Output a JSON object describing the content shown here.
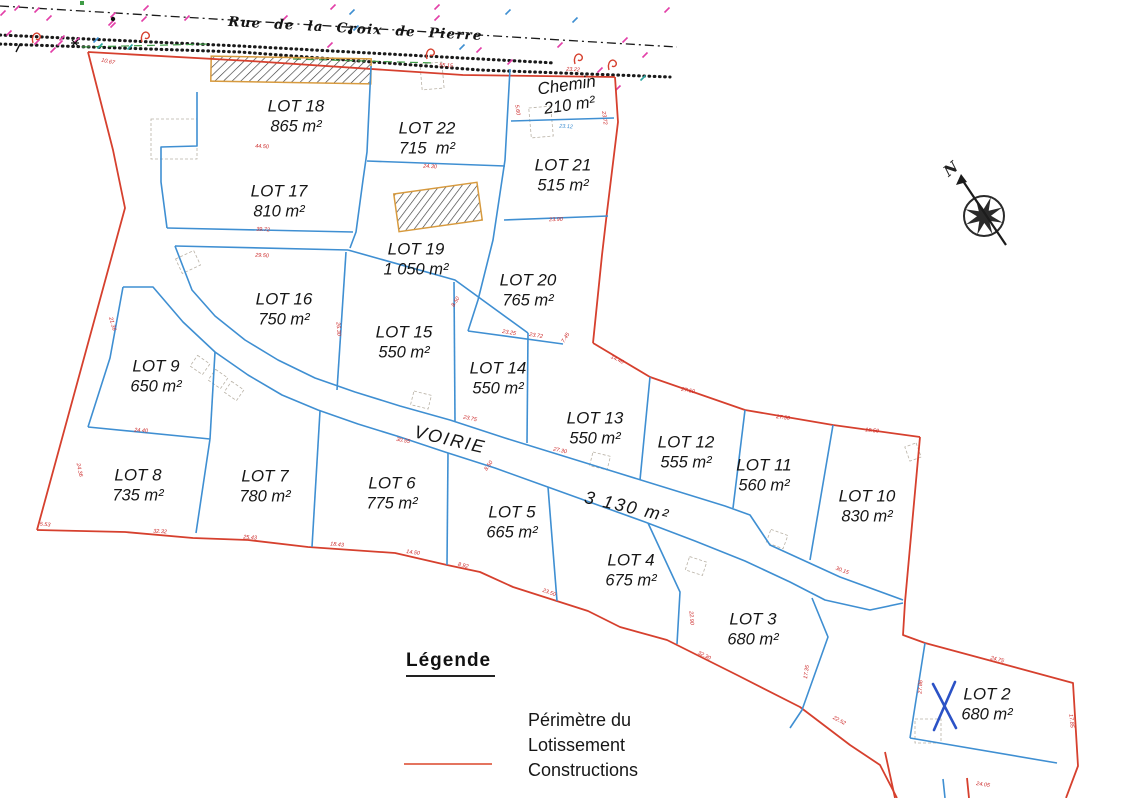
{
  "street": {
    "name": "Rue de la Croix de Pierre"
  },
  "compass": {
    "label": "N"
  },
  "road": {
    "name": "VOIRIE",
    "area": "3 130 m²",
    "name_pos": [
      450,
      440
    ],
    "area_pos": [
      627,
      507
    ],
    "rotation": 13
  },
  "legend": {
    "title": "Légende",
    "items": [
      {
        "label": "Périmètre du Lotissement",
        "symbol": "red-line"
      },
      {
        "label": "Constructions",
        "symbol": "hatch"
      }
    ]
  },
  "lots": [
    {
      "name": "LOT 18",
      "area": "865 m²",
      "cx": 296,
      "cy": 116,
      "rot": 0
    },
    {
      "name": "LOT 22",
      "area": "715  m²",
      "cx": 427,
      "cy": 138,
      "rot": 0
    },
    {
      "name": "Chemin",
      "area": "210 m²",
      "cx": 568,
      "cy": 95,
      "rot": -8
    },
    {
      "name": "LOT 21",
      "area": "515 m²",
      "cx": 563,
      "cy": 175,
      "rot": 0
    },
    {
      "name": "LOT 17",
      "area": "810 m²",
      "cx": 279,
      "cy": 201,
      "rot": 0
    },
    {
      "name": "LOT 19",
      "area": "1 050 m²",
      "cx": 416,
      "cy": 259,
      "rot": 0
    },
    {
      "name": "LOT 20",
      "area": "765 m²",
      "cx": 528,
      "cy": 290,
      "rot": 0
    },
    {
      "name": "LOT 16",
      "area": "750 m²",
      "cx": 284,
      "cy": 309,
      "rot": 0
    },
    {
      "name": "LOT 15",
      "area": "550 m²",
      "cx": 404,
      "cy": 342,
      "rot": 0
    },
    {
      "name": "LOT 14",
      "area": "550 m²",
      "cx": 498,
      "cy": 378,
      "rot": 0
    },
    {
      "name": "LOT 9",
      "area": "650 m²",
      "cx": 156,
      "cy": 376,
      "rot": 0
    },
    {
      "name": "LOT 13",
      "area": "550 m²",
      "cx": 595,
      "cy": 428,
      "rot": 0
    },
    {
      "name": "LOT 12",
      "area": "555 m²",
      "cx": 686,
      "cy": 452,
      "rot": 0
    },
    {
      "name": "LOT 11",
      "area": "560 m²",
      "cx": 764,
      "cy": 475,
      "rot": 0
    },
    {
      "name": "LOT 10",
      "area": "830 m²",
      "cx": 867,
      "cy": 506,
      "rot": 0
    },
    {
      "name": "LOT 8",
      "area": "735 m²",
      "cx": 138,
      "cy": 485,
      "rot": 0
    },
    {
      "name": "LOT 7",
      "area": "780 m²",
      "cx": 265,
      "cy": 486,
      "rot": 0
    },
    {
      "name": "LOT 6",
      "area": "775 m²",
      "cx": 392,
      "cy": 493,
      "rot": 0
    },
    {
      "name": "LOT 5",
      "area": "665 m²",
      "cx": 512,
      "cy": 522,
      "rot": 0
    },
    {
      "name": "LOT 4",
      "area": "675 m²",
      "cx": 631,
      "cy": 570,
      "rot": 0
    },
    {
      "name": "LOT 3",
      "area": "680 m²",
      "cx": 753,
      "cy": 629,
      "rot": 0
    },
    {
      "name": "LOT 2",
      "area": "680 m²",
      "cx": 987,
      "cy": 704,
      "rot": 0
    }
  ],
  "measurements": [
    [
      "10.67",
      108,
      62,
      12
    ],
    [
      "55.15",
      446,
      66,
      3
    ],
    [
      "23.22",
      573,
      70,
      3
    ],
    [
      "23.72",
      604,
      118,
      82
    ],
    [
      "5.60",
      517,
      110,
      82
    ],
    [
      "23.12",
      566,
      127,
      3,
      "#3f8fd2"
    ],
    [
      "23.90",
      556,
      220,
      -2
    ],
    [
      "24.30",
      430,
      167,
      3
    ],
    [
      "44.50",
      262,
      147,
      3
    ],
    [
      "39.72",
      263,
      230,
      3
    ],
    [
      "29.50",
      262,
      256,
      3
    ],
    [
      "21.36",
      112,
      324,
      74
    ],
    [
      "24.40",
      141,
      431,
      4
    ],
    [
      "24.36",
      79,
      470,
      78
    ],
    [
      "5.53",
      45,
      525,
      5
    ],
    [
      "32.32",
      160,
      532,
      3
    ],
    [
      "25.43",
      250,
      538,
      4
    ],
    [
      "18.43",
      337,
      545,
      5
    ],
    [
      "14.50",
      413,
      553,
      8
    ],
    [
      "8.92",
      463,
      566,
      14
    ],
    [
      "23.50",
      549,
      593,
      20
    ],
    [
      "30.15",
      842,
      571,
      21
    ],
    [
      "17.35",
      807,
      672,
      -82
    ],
    [
      "22.90",
      691,
      618,
      86
    ],
    [
      "32.30",
      704,
      656,
      26
    ],
    [
      "22.52",
      839,
      721,
      28
    ],
    [
      "24.75",
      997,
      660,
      14
    ],
    [
      "24.05",
      983,
      785,
      8
    ],
    [
      "27.86",
      921,
      687,
      -86
    ],
    [
      "17.85",
      1071,
      721,
      84
    ],
    [
      "27.50",
      688,
      391,
      11
    ],
    [
      "27.50",
      783,
      418,
      7
    ],
    [
      "19.50",
      872,
      431,
      6
    ],
    [
      "14.40",
      617,
      360,
      26
    ],
    [
      "7.45",
      566,
      338,
      -58
    ],
    [
      "23.25",
      509,
      333,
      9
    ],
    [
      "23.72",
      536,
      336,
      9
    ],
    [
      "8.50",
      456,
      302,
      -58
    ],
    [
      "26.30",
      338,
      329,
      86
    ],
    [
      "23.75",
      470,
      419,
      12
    ],
    [
      "27.30",
      560,
      451,
      12
    ],
    [
      "30.55",
      403,
      441,
      10
    ],
    [
      "8.50",
      489,
      466,
      -55
    ]
  ],
  "colors": {
    "perimeter": "#d6402e",
    "legend_swatch": "#e4745f",
    "lot_line": "#3f8fd2",
    "x_mark": "#2b52c6",
    "hatch_border": "#d79a3e",
    "hatch_stroke": "#3a3a3a",
    "measurement": "#cc2a2a",
    "magenta": "#e33fa8",
    "green": "#3f9c46",
    "teal": "#2ba6a0",
    "black_line": "#1a1a1a"
  },
  "geometry": {
    "black_dashdot": [
      [
        [
          0,
          6
        ],
        [
          677,
          47
        ]
      ]
    ],
    "black_dotted": [
      [
        [
          0,
          35
        ],
        [
          240,
          46
        ],
        [
          555,
          63
        ]
      ],
      [
        [
          0,
          44
        ],
        [
          240,
          52
        ],
        [
          480,
          70
        ],
        [
          670,
          77
        ]
      ]
    ],
    "green_dashed": [
      [
        [
          82,
          47
        ],
        [
          210,
          44
        ]
      ],
      [
        [
          293,
          59
        ],
        [
          435,
          63
        ]
      ]
    ],
    "red_segments": [
      [
        [
          88,
          52
        ],
        [
          250,
          61
        ],
        [
          463,
          75
        ],
        [
          615,
          77
        ]
      ],
      [
        [
          615,
          77
        ],
        [
          618,
          122
        ],
        [
          607,
          212
        ],
        [
          602,
          255
        ],
        [
          593,
          343
        ]
      ],
      [
        [
          593,
          343
        ],
        [
          650,
          377
        ],
        [
          745,
          410
        ],
        [
          833,
          425
        ],
        [
          920,
          437
        ]
      ],
      [
        [
          920,
          437
        ],
        [
          905,
          602
        ],
        [
          903,
          635
        ],
        [
          925,
          643
        ],
        [
          1073,
          683
        ],
        [
          1078,
          766
        ],
        [
          1066,
          798
        ]
      ],
      [
        [
          88,
          52
        ],
        [
          113,
          150
        ],
        [
          125,
          208
        ],
        [
          37,
          530
        ]
      ],
      [
        [
          37,
          530
        ],
        [
          125,
          532
        ],
        [
          193,
          538
        ],
        [
          248,
          540
        ],
        [
          308,
          547
        ],
        [
          395,
          553
        ],
        [
          447,
          565
        ],
        [
          480,
          572
        ],
        [
          513,
          587
        ],
        [
          588,
          611
        ],
        [
          620,
          627
        ],
        [
          667,
          640
        ],
        [
          737,
          675
        ],
        [
          800,
          707
        ],
        [
          850,
          745
        ],
        [
          880,
          765
        ],
        [
          897,
          798
        ]
      ],
      [
        [
          885,
          752
        ],
        [
          895,
          798
        ]
      ],
      [
        [
          967,
          778
        ],
        [
          969,
          798
        ]
      ]
    ],
    "blue_segments": [
      [
        [
          197,
          92
        ],
        [
          197,
          146
        ],
        [
          161,
          147
        ],
        [
          161,
          182
        ],
        [
          167,
          228
        ]
      ],
      [
        [
          167,
          228
        ],
        [
          353,
          232
        ]
      ],
      [
        [
          175,
          246
        ],
        [
          348,
          250
        ]
      ],
      [
        [
          371,
          66
        ],
        [
          367,
          152
        ],
        [
          363,
          180
        ],
        [
          356,
          232
        ],
        [
          350,
          248
        ]
      ],
      [
        [
          367,
          161
        ],
        [
          505,
          166
        ]
      ],
      [
        [
          510,
          69
        ],
        [
          505,
          160
        ],
        [
          493,
          240
        ],
        [
          478,
          300
        ],
        [
          468,
          331
        ]
      ],
      [
        [
          511,
          121
        ],
        [
          614,
          118
        ]
      ],
      [
        [
          504,
          220
        ],
        [
          608,
          216
        ]
      ],
      [
        [
          468,
          331
        ],
        [
          563,
          344
        ]
      ],
      [
        [
          348,
          250
        ],
        [
          455,
          280
        ],
        [
          528,
          333
        ]
      ],
      [
        [
          346,
          252
        ],
        [
          337,
          390
        ]
      ],
      [
        [
          454,
          282
        ],
        [
          455,
          421
        ]
      ],
      [
        [
          528,
          333
        ],
        [
          527,
          443
        ]
      ],
      [
        [
          650,
          377
        ],
        [
          640,
          480
        ]
      ],
      [
        [
          745,
          410
        ],
        [
          733,
          508
        ]
      ],
      [
        [
          833,
          425
        ],
        [
          810,
          560
        ]
      ],
      [
        [
          175,
          246
        ],
        [
          192,
          290
        ],
        [
          215,
          316
        ],
        [
          245,
          340
        ],
        [
          278,
          360
        ],
        [
          315,
          378
        ],
        [
          355,
          392
        ],
        [
          400,
          406
        ],
        [
          450,
          420
        ],
        [
          505,
          438
        ],
        [
          560,
          455
        ],
        [
          615,
          472
        ],
        [
          670,
          489
        ],
        [
          725,
          506
        ],
        [
          750,
          515
        ],
        [
          770,
          545
        ],
        [
          840,
          577
        ],
        [
          903,
          600
        ]
      ],
      [
        [
          123,
          287
        ],
        [
          153,
          287
        ],
        [
          183,
          322
        ],
        [
          215,
          352
        ],
        [
          248,
          375
        ],
        [
          282,
          395
        ],
        [
          318,
          410
        ],
        [
          358,
          424
        ],
        [
          400,
          437
        ],
        [
          445,
          452
        ],
        [
          495,
          468
        ],
        [
          545,
          486
        ],
        [
          595,
          504
        ],
        [
          645,
          522
        ],
        [
          695,
          541
        ],
        [
          745,
          561
        ],
        [
          790,
          582
        ],
        [
          825,
          600
        ],
        [
          870,
          610
        ],
        [
          903,
          603
        ]
      ],
      [
        [
          123,
          287
        ],
        [
          110,
          358
        ],
        [
          88,
          427
        ]
      ],
      [
        [
          88,
          427
        ],
        [
          210,
          439
        ]
      ],
      [
        [
          215,
          352
        ],
        [
          210,
          439
        ]
      ],
      [
        [
          210,
          439
        ],
        [
          196,
          533
        ]
      ],
      [
        [
          320,
          411
        ],
        [
          312,
          547
        ]
      ],
      [
        [
          448,
          453
        ],
        [
          447,
          565
        ]
      ],
      [
        [
          548,
          487
        ],
        [
          557,
          601
        ]
      ],
      [
        [
          648,
          523
        ],
        [
          680,
          592
        ],
        [
          677,
          644
        ]
      ],
      [
        [
          812,
          598
        ],
        [
          828,
          637
        ],
        [
          802,
          710
        ],
        [
          790,
          728
        ]
      ],
      [
        [
          925,
          643
        ],
        [
          910,
          738
        ]
      ],
      [
        [
          910,
          738
        ],
        [
          1057,
          763
        ]
      ],
      [
        [
          943,
          779
        ],
        [
          945,
          798
        ]
      ]
    ],
    "x_mark_segments": [
      [
        [
          933,
          684
        ],
        [
          956,
          728
        ]
      ],
      [
        [
          955,
          682
        ],
        [
          934,
          730
        ]
      ]
    ],
    "hatch_rects": [
      {
        "cx": 291,
        "cy": 70,
        "w": 160,
        "h": 25,
        "deg": 1
      },
      {
        "cx": 438,
        "cy": 207,
        "w": 84,
        "h": 38,
        "deg": -8
      }
    ],
    "parking_rects": [
      [
        174,
        139,
        46,
        40,
        0
      ],
      [
        432,
        76,
        22,
        26,
        -5
      ],
      [
        541,
        122,
        22,
        30,
        -5
      ],
      [
        188,
        262,
        20,
        16,
        -25
      ],
      [
        200,
        365,
        15,
        13,
        35
      ],
      [
        218,
        379,
        15,
        13,
        35
      ],
      [
        234,
        391,
        15,
        13,
        35
      ],
      [
        421,
        400,
        18,
        14,
        14
      ],
      [
        600,
        461,
        18,
        14,
        14
      ],
      [
        696,
        566,
        18,
        14,
        18
      ],
      [
        777,
        539,
        18,
        14,
        20
      ],
      [
        913,
        452,
        15,
        12,
        70
      ],
      [
        928,
        731,
        26,
        24,
        0
      ]
    ],
    "magenta_marks": [
      [
        3,
        13
      ],
      [
        17,
        8
      ],
      [
        37,
        10
      ],
      [
        49,
        18
      ],
      [
        113,
        25
      ],
      [
        113,
        15
      ],
      [
        60,
        43
      ],
      [
        37,
        42
      ],
      [
        9,
        33
      ],
      [
        53,
        50
      ],
      [
        62,
        38
      ],
      [
        77,
        40
      ],
      [
        111,
        23
      ],
      [
        144,
        19
      ],
      [
        146,
        8
      ],
      [
        333,
        7
      ],
      [
        285,
        18
      ],
      [
        330,
        45
      ],
      [
        437,
        18
      ],
      [
        437,
        7
      ],
      [
        479,
        50
      ],
      [
        625,
        40
      ],
      [
        645,
        55
      ],
      [
        667,
        10
      ],
      [
        187,
        18
      ],
      [
        560,
        45
      ],
      [
        510,
        62
      ],
      [
        600,
        70
      ],
      [
        618,
        88
      ]
    ],
    "blue_marks": [
      [
        462,
        47
      ],
      [
        508,
        12
      ],
      [
        575,
        20
      ],
      [
        356,
        28
      ],
      [
        96,
        40
      ],
      [
        352,
        12
      ]
    ],
    "teal_marks": [
      [
        100,
        46
      ],
      [
        130,
        47
      ],
      [
        643,
        78
      ]
    ],
    "hooks": [
      [
        33,
        34
      ],
      [
        142,
        33
      ],
      [
        427,
        50
      ],
      [
        575,
        55
      ],
      [
        609,
        61
      ]
    ],
    "black_dots": [
      [
        113,
        19
      ],
      [
        350,
        32
      ]
    ],
    "asterisk": [
      75,
      43
    ],
    "slash": [
      18,
      48
    ],
    "green_square": [
      82,
      3
    ],
    "compass": {
      "cx": 984,
      "cy": 216,
      "r": 20,
      "needle": [
        [
          1006,
          245
        ],
        [
          961,
          178
        ]
      ]
    }
  }
}
